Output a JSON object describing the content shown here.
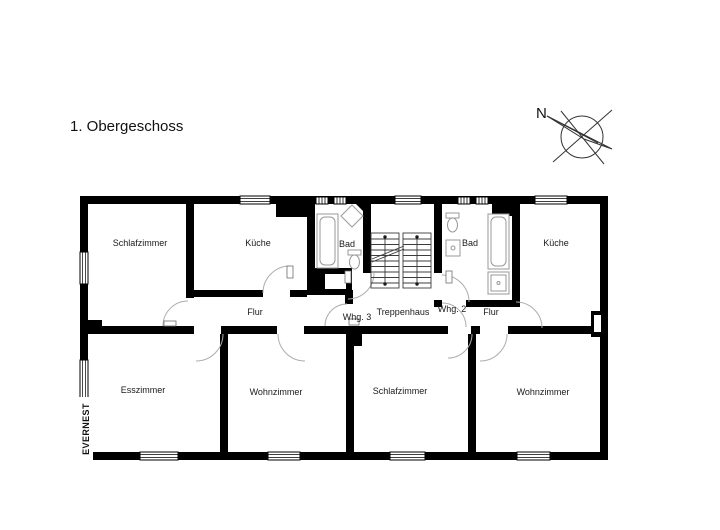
{
  "title": "1. Obergeschoss",
  "compass": {
    "north_label": "N"
  },
  "watermark": "EVERNEST",
  "floor_plan": {
    "rooms": {
      "schlafzimmer_top_left": "Schlafzimmer",
      "kueche_left": "Küche",
      "bad_left": "Bad",
      "treppenhaus": "Treppenhaus",
      "bad_right": "Bad",
      "kueche_right": "Küche",
      "flur_left": "Flur",
      "whg_3": "Whg. 3",
      "whg_2": "Whg. 2",
      "flur_right": "Flur",
      "esszimmer": "Esszimmer",
      "wohnzimmer_left": "Wohnzimmer",
      "schlafzimmer_bottom": "Schlafzimmer",
      "wohnzimmer_right": "Wohnzimmer"
    },
    "colors": {
      "wall": "#000000",
      "background": "#ffffff",
      "door_arc": "#adadad",
      "fixture": "#999999",
      "text": "#1a1a1a"
    }
  }
}
